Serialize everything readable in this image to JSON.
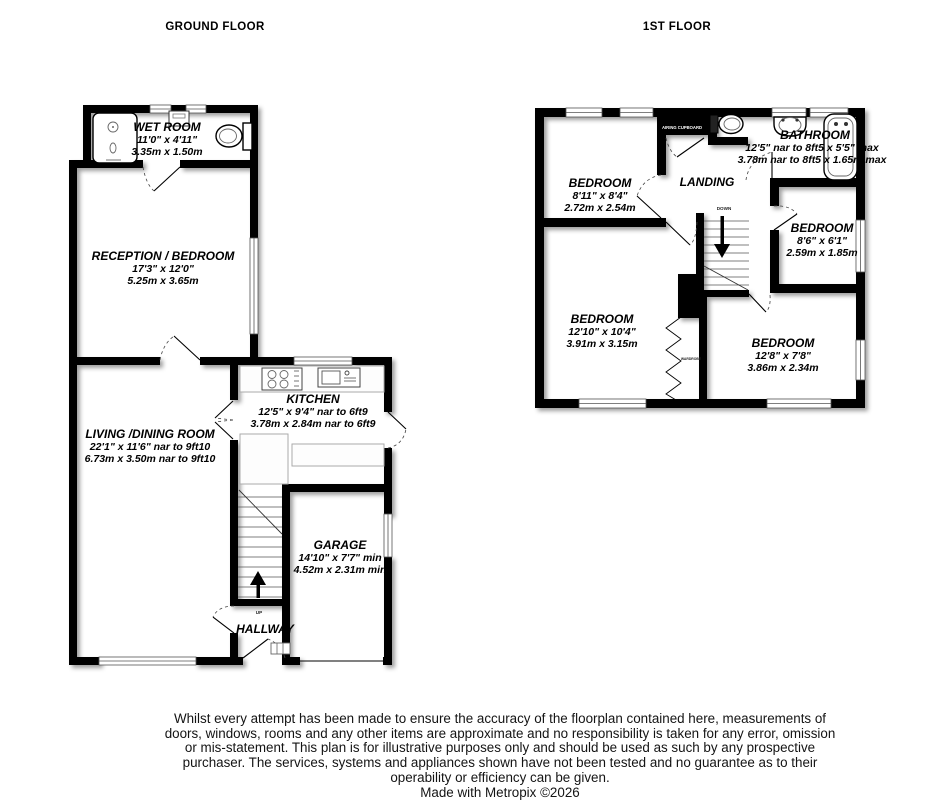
{
  "titles": {
    "ground": "GROUND FLOOR",
    "first": "1ST FLOOR"
  },
  "colors": {
    "wall": "#000000",
    "background": "#ffffff"
  },
  "ground_floor": {
    "rooms": {
      "wet_room": {
        "name": "WET ROOM",
        "imperial": "11'0\" x 4'11\"",
        "metric": "3.35m x 1.50m"
      },
      "reception": {
        "name": "RECEPTION / BEDROOM",
        "imperial": "17'3\" x 12'0\"",
        "metric": "5.25m x 3.65m"
      },
      "living": {
        "name": "LIVING /DINING ROOM",
        "imperial": "22'1\" x 11'6\" nar to 9ft10",
        "metric": "6.73m x 3.50m nar to 9ft10"
      },
      "kitchen": {
        "name": "KITCHEN",
        "imperial": "12'5\" x 9'4\" nar to 6ft9",
        "metric": "3.78m x 2.84m nar to 6ft9"
      },
      "garage": {
        "name": "GARAGE",
        "imperial": "14'10\" x 7'7\" min",
        "metric": "4.52m x 2.31m min"
      }
    },
    "hallway": "HALLWAY",
    "stairs_up": "UP"
  },
  "first_floor": {
    "rooms": {
      "bedroom_top_left": {
        "name": "BEDROOM",
        "imperial": "8'11\" x 8'4\"",
        "metric": "2.72m x 2.54m"
      },
      "bathroom": {
        "name": "BATHROOM",
        "imperial": "12'5\" nar to 8ft5 x 5'5\" max",
        "metric": "3.78m nar to 8ft5 x 1.65m max"
      },
      "bedroom_mid_right": {
        "name": "BEDROOM",
        "imperial": "8'6\" x 6'1\"",
        "metric": "2.59m x 1.85m"
      },
      "bedroom_bottom_left": {
        "name": "BEDROOM",
        "imperial": "12'10\" x 10'4\"",
        "metric": "3.91m x 3.15m"
      },
      "bedroom_bottom_right": {
        "name": "BEDROOM",
        "imperial": "12'8\" x 7'8\"",
        "metric": "3.86m x 2.34m"
      }
    },
    "landing": "LANDING",
    "stairs_down": "DOWN",
    "airing_cupboard": "AIRING CUPBOARD",
    "wardrobe": "WARDROBE"
  },
  "footer": {
    "disclaimer": "Whilst every attempt has been made to ensure the accuracy of the floorplan contained here, measurements of doors, windows, rooms and any other items are approximate and no responsibility is taken for any error, omission or mis-statement. This plan is for illustrative purposes only and should be used as such by any prospective purchaser. The services, systems and appliances shown have not been tested and no guarantee as to their operability or efficiency can be given.",
    "credit": "Made with Metropix ©2026"
  }
}
